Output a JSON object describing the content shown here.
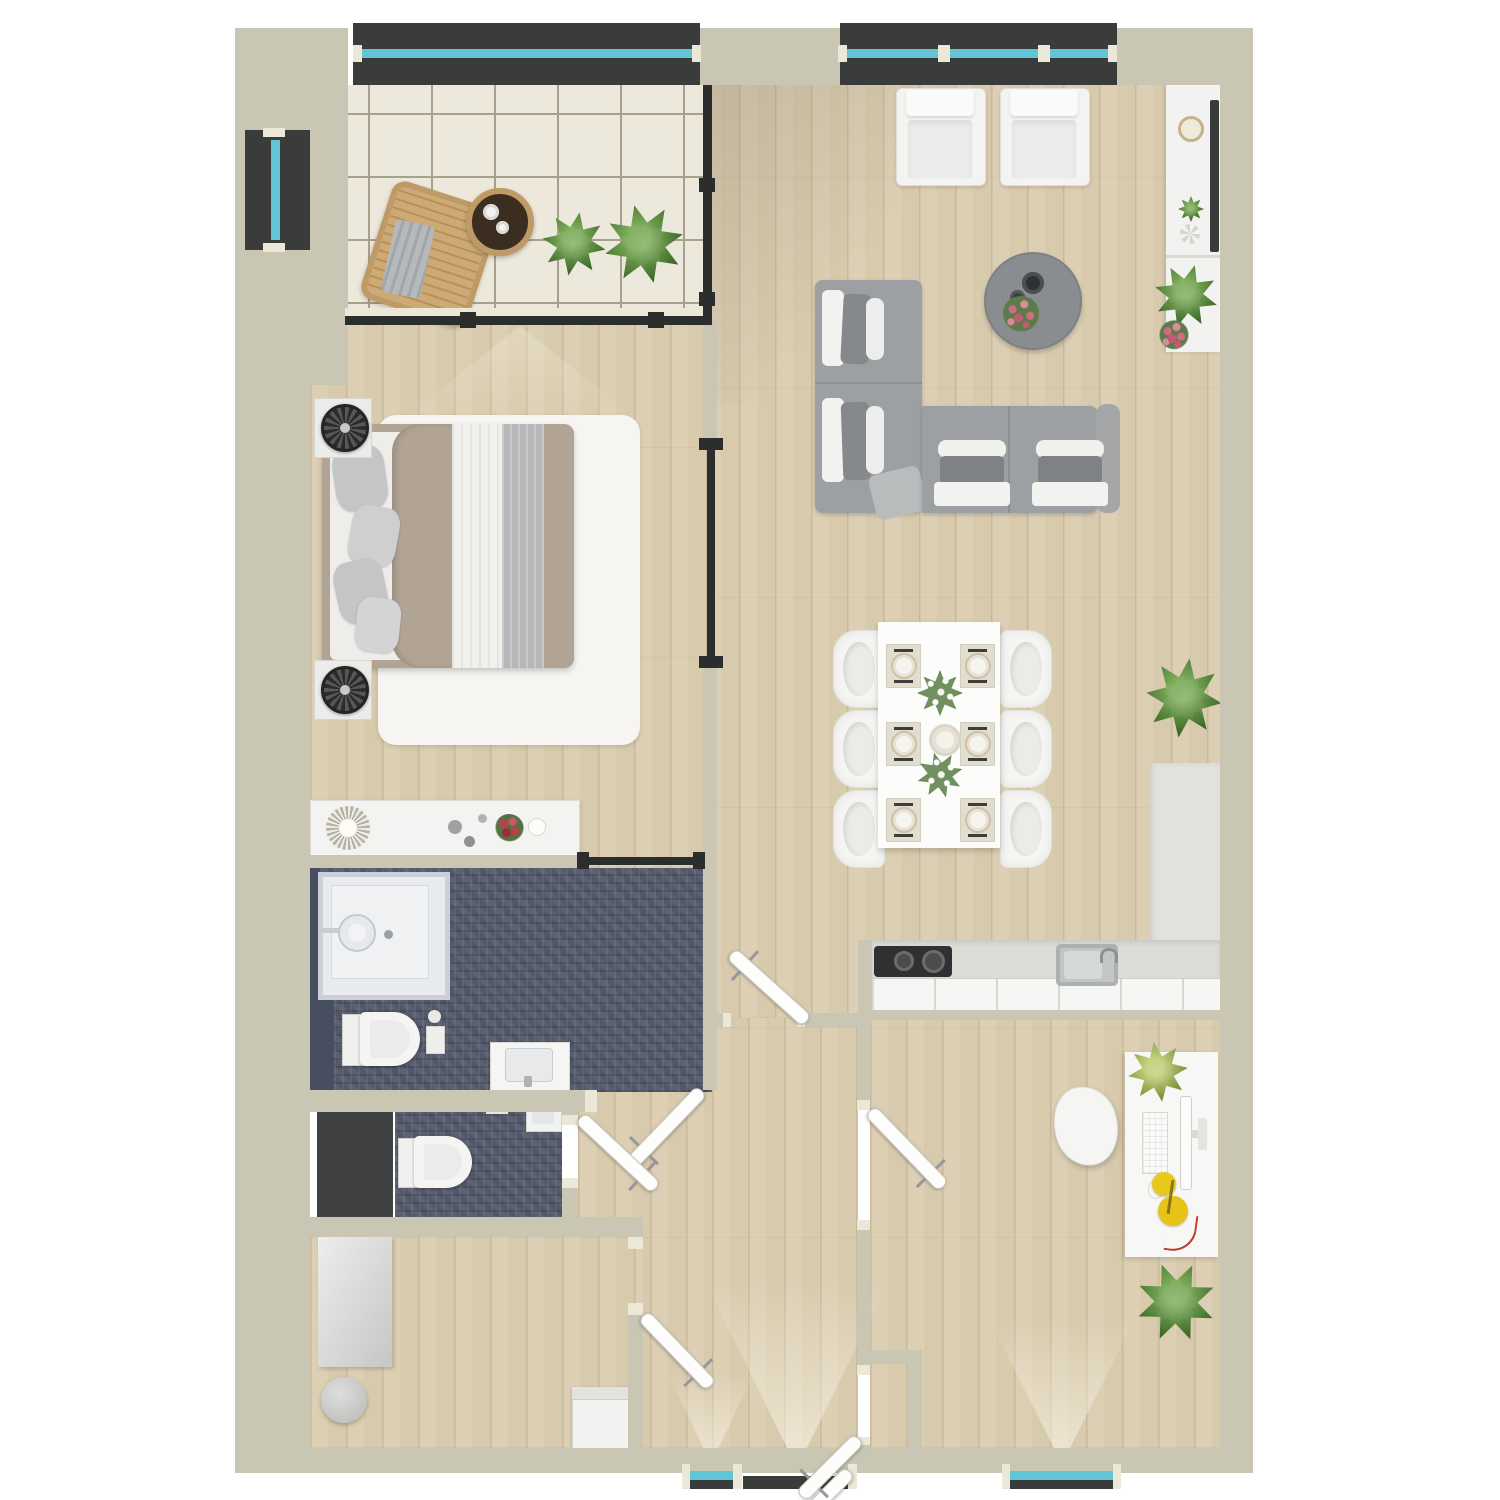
{
  "plan": {
    "kind": "residential-apartment-floor-plan",
    "view": "top-down-render",
    "visible_text": "none"
  },
  "palette": {
    "wall": "#c9c6b3",
    "wall-cap": "#ece8d8",
    "wood": "#d8caac",
    "tile": "#ece8db",
    "tile-line": "#a7a08b",
    "bath-tile": "#5b6172",
    "charcoal": "#3f4142",
    "window-frame": "#3a3c3c",
    "glazing": "#62c5d6",
    "rail": "#2c2d2d",
    "furniture-white": "#f4f4f2",
    "sofa-gray": "#9da0a2",
    "counter-gray": "#e3e1dd",
    "rug-white": "#f6f5f1",
    "bed-taupe": "#b2a495",
    "wicker-tan": "#c09a66",
    "plant-green": "#4e7c36",
    "plant-lime": "#8ea24c",
    "flower-pink": "#cf6d80",
    "flower-red": "#b8414b",
    "lamp-yellow": "#e9c81c",
    "cable-red": "#c0392b"
  },
  "rooms": [
    {
      "id": "balcony",
      "name": "balcony",
      "furniture": [
        "wicker-lounge-chair",
        "round-side-table",
        "two-cups",
        "potted-plant",
        "potted-plant"
      ]
    },
    {
      "id": "living-room",
      "name": "living room",
      "furniture": [
        "armchair",
        "armchair",
        "round-coffee-table",
        "corner-sofa",
        "media-sideboard",
        "wall-tv",
        "decor-bowl",
        "small-plant",
        "large-plant",
        "pink-flowers"
      ]
    },
    {
      "id": "dining-area",
      "name": "dining area",
      "furniture": [
        "dining-table",
        "six-chairs",
        "six-place-settings",
        "two-green-centerpieces",
        "center-dish",
        "floor-plant"
      ]
    },
    {
      "id": "kitchen",
      "name": "kitchen",
      "furniture": [
        "l-shaped-counter",
        "cooktop",
        "sink-with-faucet",
        "cabinet-fronts"
      ]
    },
    {
      "id": "bedroom",
      "name": "bedroom",
      "furniture": [
        "double-bed",
        "nightstand",
        "nightstand",
        "fan-lamp",
        "fan-lamp",
        "area-rug",
        "dresser",
        "sunburst-decor",
        "red-flowers"
      ]
    },
    {
      "id": "bathroom",
      "name": "bathroom",
      "furniture": [
        "shower",
        "wall-hung-toilet",
        "vanity-sink"
      ]
    },
    {
      "id": "wc",
      "name": "separate wc",
      "furniture": [
        "wall-hung-toilet",
        "hand-basin",
        "charcoal-closet"
      ]
    },
    {
      "id": "hallway",
      "name": "hallway",
      "furniture": [
        "entrance-double-door"
      ]
    },
    {
      "id": "storage-room",
      "name": "storage / utility room",
      "furniture": [
        "tall-cabinet",
        "round-stool",
        "appliance"
      ]
    },
    {
      "id": "office",
      "name": "home office",
      "furniture": [
        "desk",
        "monitor",
        "keyboard",
        "mouse",
        "yellow-desk-lamp",
        "red-cable",
        "desk-chair",
        "desk-plant",
        "floor-plant",
        "hall-closet"
      ]
    }
  ],
  "openings": {
    "windows": [
      {
        "id": "balcony-top-window",
        "wall": "north"
      },
      {
        "id": "balcony-side-window",
        "wall": "west"
      },
      {
        "id": "living-top-window",
        "wall": "north"
      },
      {
        "id": "hall-bottom-window",
        "wall": "south"
      },
      {
        "id": "office-bottom-window",
        "wall": "south"
      }
    ],
    "doors": [
      {
        "id": "entrance-door",
        "type": "double-swing"
      },
      {
        "id": "bedroom-sliding-door",
        "type": "sliding"
      },
      {
        "id": "bedroom-bathroom-slider",
        "type": "sliding"
      },
      {
        "id": "bathroom-door",
        "type": "swing"
      },
      {
        "id": "wc-door",
        "type": "swing"
      },
      {
        "id": "storage-door",
        "type": "swing"
      },
      {
        "id": "office-door",
        "type": "swing"
      },
      {
        "id": "hall-closet-door",
        "type": "swing"
      },
      {
        "id": "corridor-door",
        "type": "swing"
      }
    ]
  }
}
